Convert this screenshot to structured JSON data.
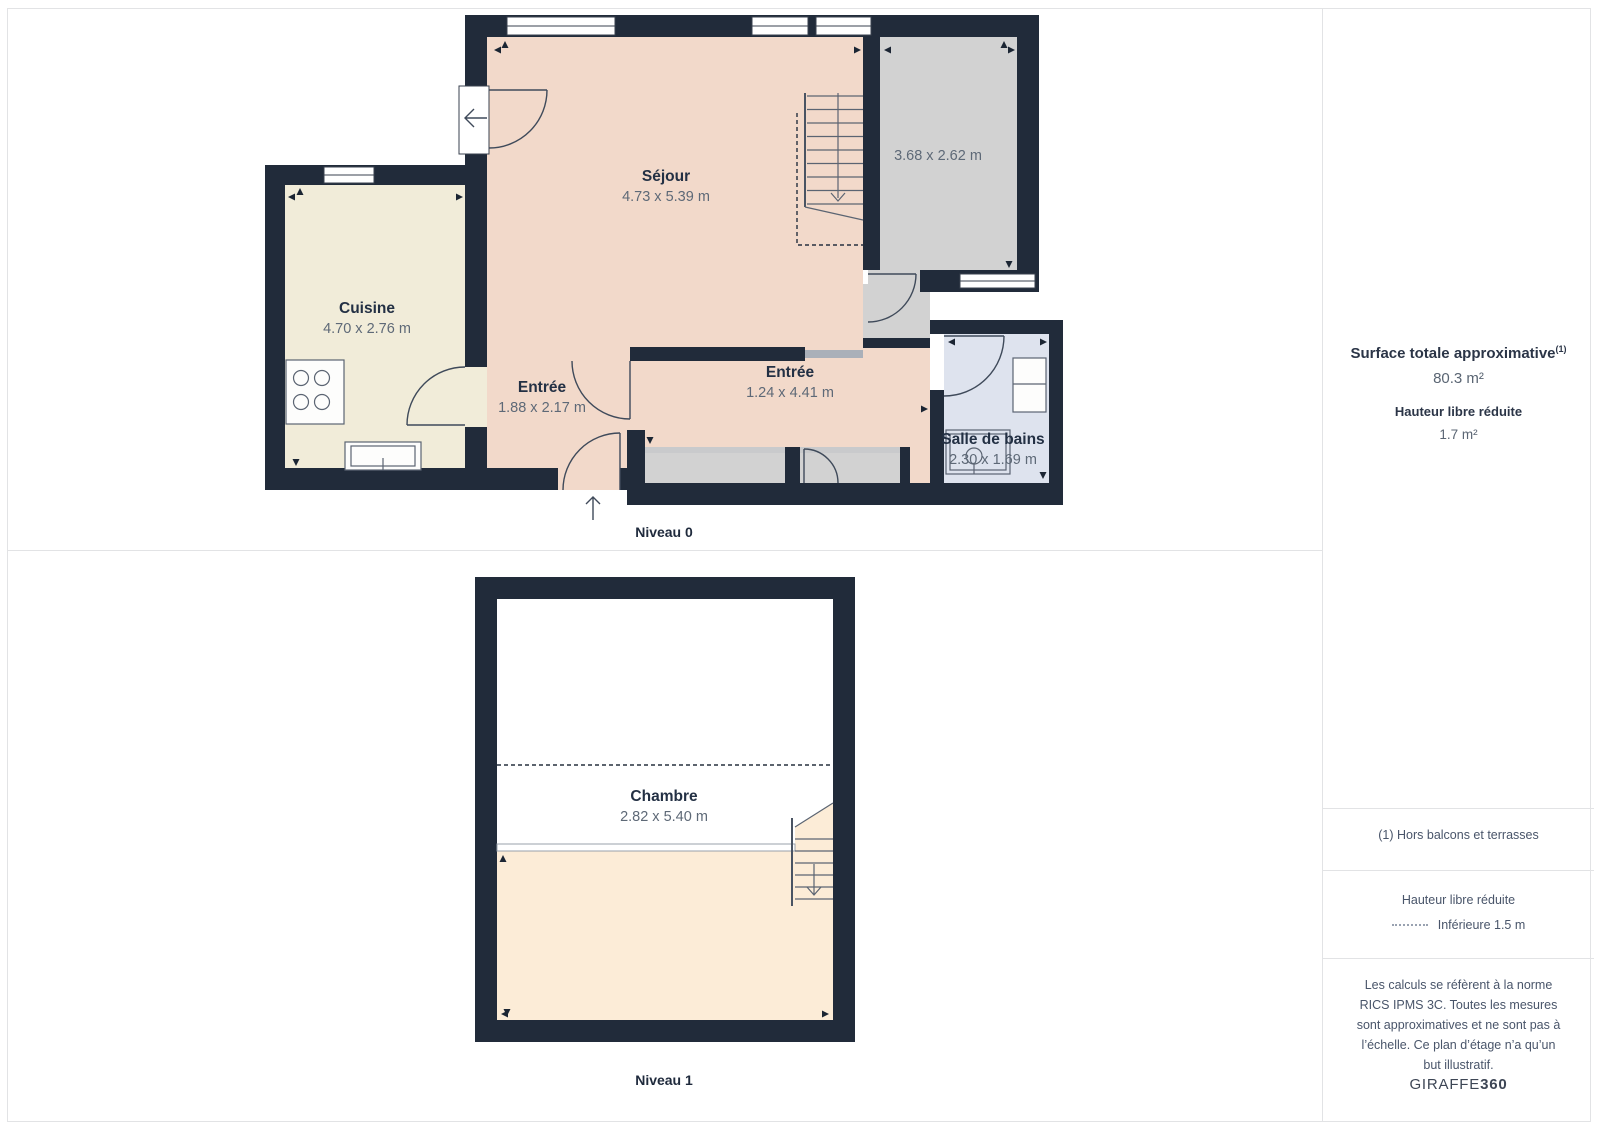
{
  "plan": {
    "levels": [
      {
        "label": "Niveau 0",
        "rooms": [
          {
            "name": "Séjour",
            "dims": "4.73 x 5.39 m"
          },
          {
            "name": "",
            "dims": "3.68 x 2.62 m"
          },
          {
            "name": "Cuisine",
            "dims": "4.70 x 2.76 m"
          },
          {
            "name": "Entrée",
            "dims": "1.88 x 2.17 m"
          },
          {
            "name": "Entrée",
            "dims": "1.24 x 4.41 m"
          },
          {
            "name": "Salle de bains",
            "dims": "2.30 x 1.69 m"
          }
        ]
      },
      {
        "label": "Niveau 1",
        "rooms": [
          {
            "name": "Chambre",
            "dims": "2.82 x 5.40 m"
          }
        ]
      }
    ]
  },
  "sidebar": {
    "surface_title": "Surface totale approximative",
    "surface_footnote_marker": "(1)",
    "surface_value": "80.3 m²",
    "reduced_height_title": "Hauteur libre réduite",
    "reduced_height_value": "1.7 m²",
    "footnote": "(1) Hors balcons et terrasses",
    "legend_title": "Hauteur libre réduite",
    "legend_item": "Inférieure 1.5 m",
    "disclaimer": "Les calculs se réfèrent à la norme RICS IPMS 3C. Toutes les mesures sont approximatives et ne sont pas à l’échelle. Ce plan d’étage n’a qu’un but illustratif.",
    "brand_name": "GIRAFFE",
    "brand_suffix": "360"
  },
  "colors": {
    "wall": "#212b3a",
    "room_living": "#f2d9ca",
    "room_kitchen": "#f1ecd9",
    "room_gray": "#d2d2d2",
    "room_bath": "#dee3ee",
    "room_bedroom": "#fcecd7",
    "divider": "#e2e3e5",
    "label_name": "#233044",
    "label_dims": "#5e6977"
  }
}
